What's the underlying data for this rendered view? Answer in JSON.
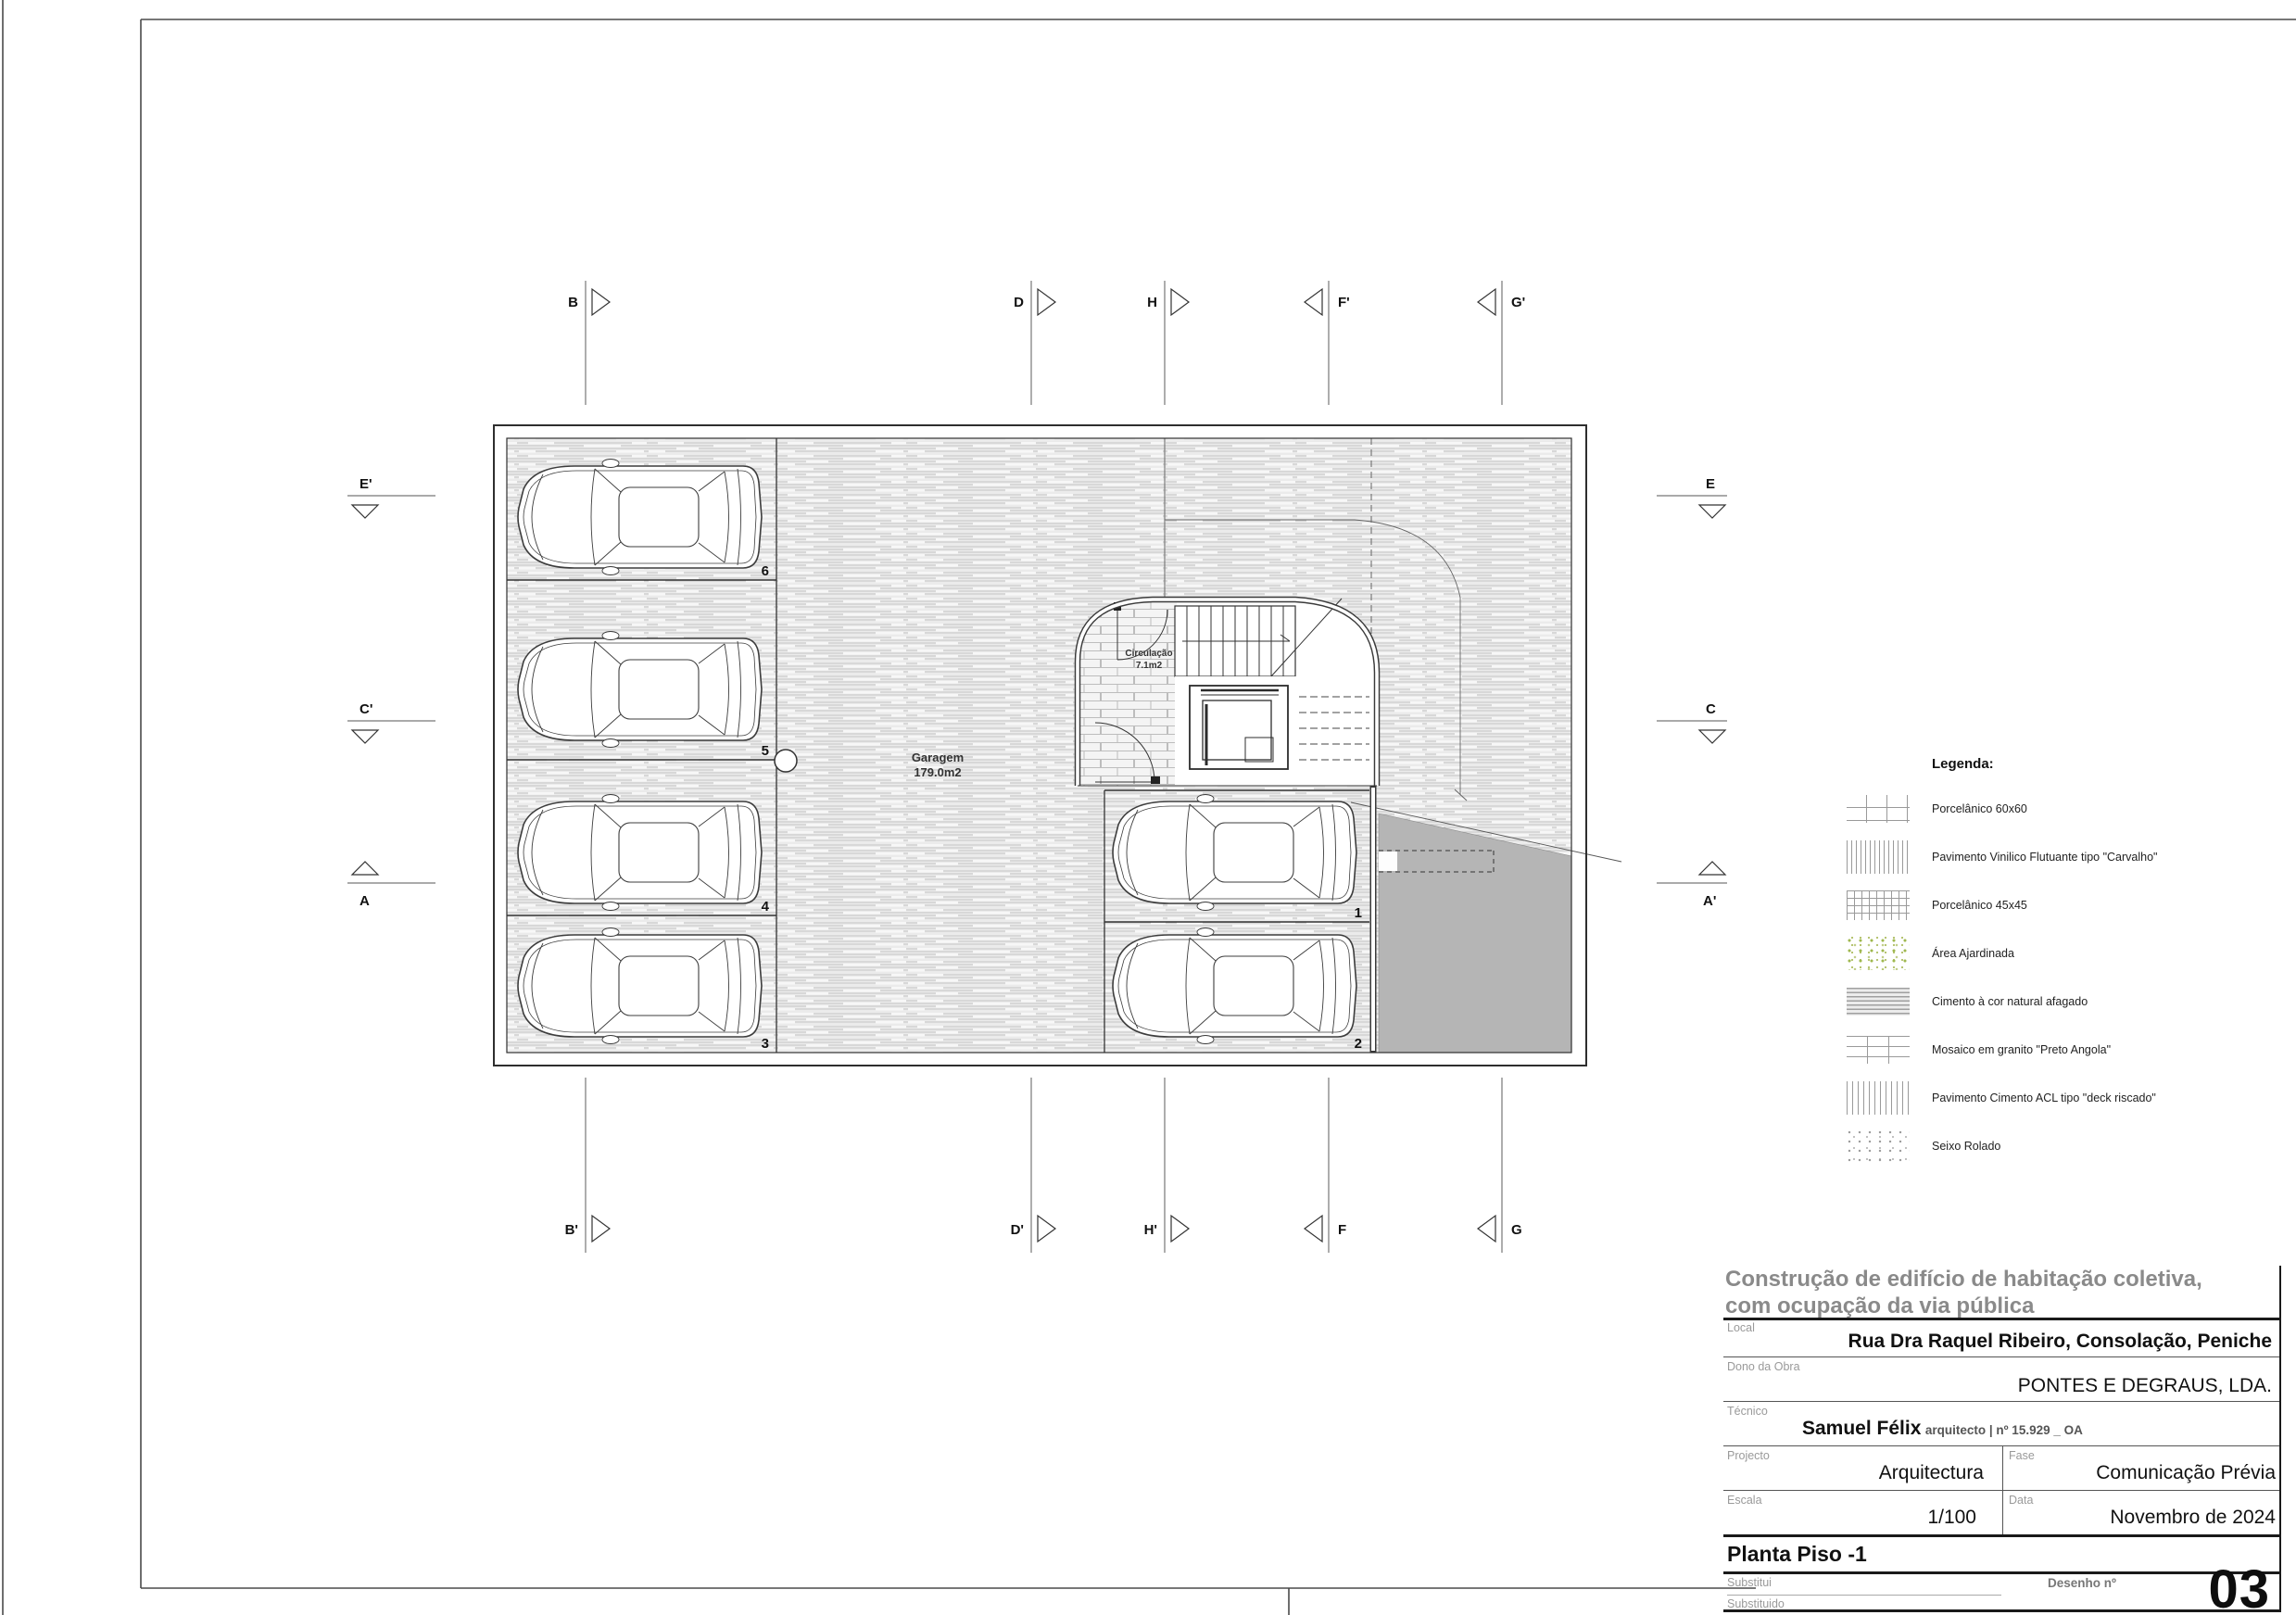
{
  "plan": {
    "garage": {
      "name": "Garagem",
      "area": "179.0m2"
    },
    "circulation": {
      "name": "Circulação",
      "area": "7.1m2"
    },
    "stalls": [
      "6",
      "5",
      "4",
      "3",
      "1",
      "2"
    ],
    "markers": {
      "top": [
        "B",
        "D",
        "H",
        "F'",
        "G'"
      ],
      "bottom": [
        "B'",
        "D'",
        "H'",
        "F",
        "G"
      ],
      "left": [
        "E'",
        "C'",
        "A"
      ],
      "right": [
        "E",
        "C",
        "A'"
      ]
    }
  },
  "legend": {
    "title": "Legenda:",
    "items": [
      {
        "label": "Porcelânico 60x60",
        "swatch": "grid-large"
      },
      {
        "label": "Pavimento Vinilico Flutuante tipo \"Carvalho\"",
        "swatch": "vertical-lines-dense"
      },
      {
        "label": "Porcelânico 45x45",
        "swatch": "grid-small"
      },
      {
        "label": "Área Ajardinada",
        "swatch": "green-dots"
      },
      {
        "label": "Cimento à cor natural afagado",
        "swatch": "horizontal-strokes"
      },
      {
        "label": "Mosaico em granito \"Preto Angola\"",
        "swatch": "brick"
      },
      {
        "label": "Pavimento Cimento ACL tipo \"deck riscado\"",
        "swatch": "vertical-lines"
      },
      {
        "label": "Seixo Rolado",
        "swatch": "gray-dots"
      }
    ]
  },
  "title_block": {
    "project_title_line1": "Construção de edifício de habitação coletiva,",
    "project_title_line2": "com ocupação da via pública",
    "local": {
      "label": "Local",
      "value": "Rua Dra Raquel Ribeiro, Consolação, Peniche"
    },
    "dono_da_obra": {
      "label": "Dono da Obra",
      "value": "PONTES E DEGRAUS, LDA."
    },
    "tecnico": {
      "label": "Técnico",
      "value": "Samuel Félix",
      "value_suffix": "arquitecto | nº 15.929 _ OA"
    },
    "projecto": {
      "label": "Projecto",
      "value": "Arquitectura"
    },
    "fase": {
      "label": "Fase",
      "value": "Comunicação Prévia"
    },
    "escala": {
      "label": "Escala",
      "value": "1/100"
    },
    "data": {
      "label": "Data",
      "value": "Novembro de 2024"
    },
    "drawing_title": "Planta Piso -1",
    "substitui_label": "Substitui",
    "substituido_label": "Substituido",
    "desenho": {
      "label": "Desenho nº",
      "value": "03"
    }
  },
  "colors": {
    "ramp_gray": "#b5b5b5",
    "hatch_line": "#c8c8c8",
    "garden_dot": "#9fb84f",
    "line_dark": "#333333"
  }
}
